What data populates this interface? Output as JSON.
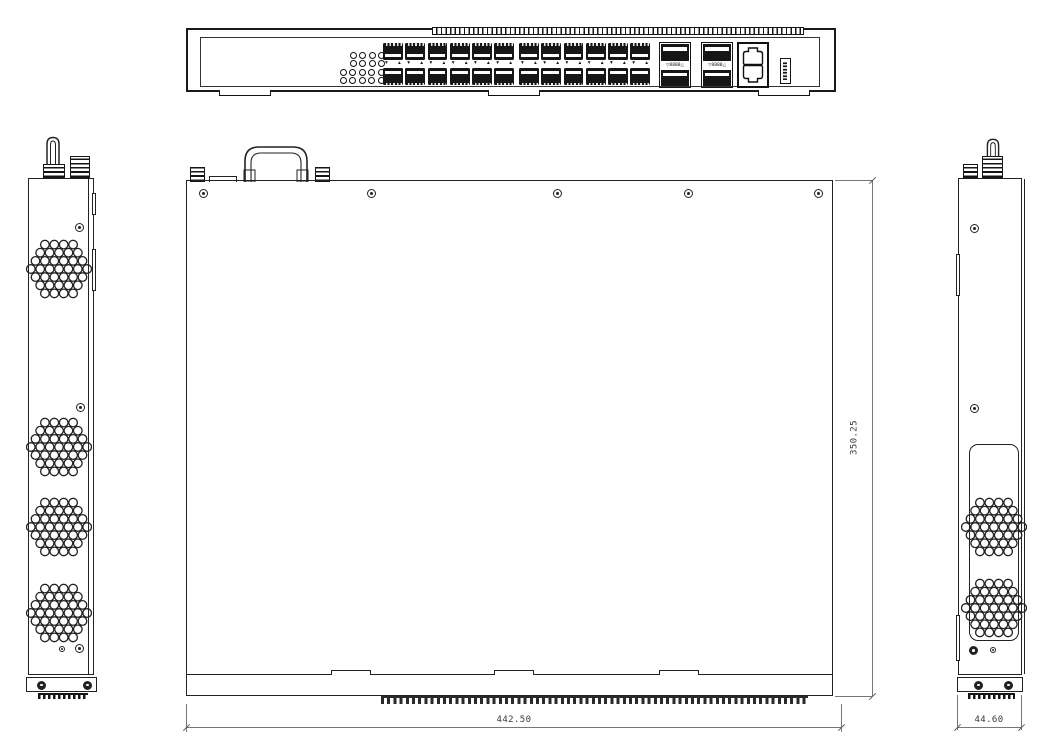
{
  "drawing": {
    "type": "mechanical-drawing-switch",
    "views": {
      "front": "front panel view",
      "left": "left side view",
      "top": "top cover view",
      "right": "right side view"
    },
    "dimensions": {
      "overall_width": "442.50",
      "overall_depth": "350.25",
      "side_width": "44.60"
    },
    "front_panel": {
      "led_rows": [
        4,
        4,
        5,
        5
      ],
      "sfp_blocks": 2,
      "sfp_columns_per_block": 6,
      "sfp_rows_per_block": 2,
      "sfp_marking_down": "▾",
      "sfp_marking_up": "▴",
      "uplink_modules": 2,
      "uplink_marking": "▽8888△",
      "rj45_stacked_ports": 2,
      "usb_ports": 1
    },
    "left_side": {
      "vent_clusters": 4,
      "screw_holes": 2
    },
    "right_side": {
      "vent_clusters": 2,
      "screw_holes": 2
    },
    "top_cover": {
      "screws": 5,
      "latch_tabs": 3
    }
  }
}
